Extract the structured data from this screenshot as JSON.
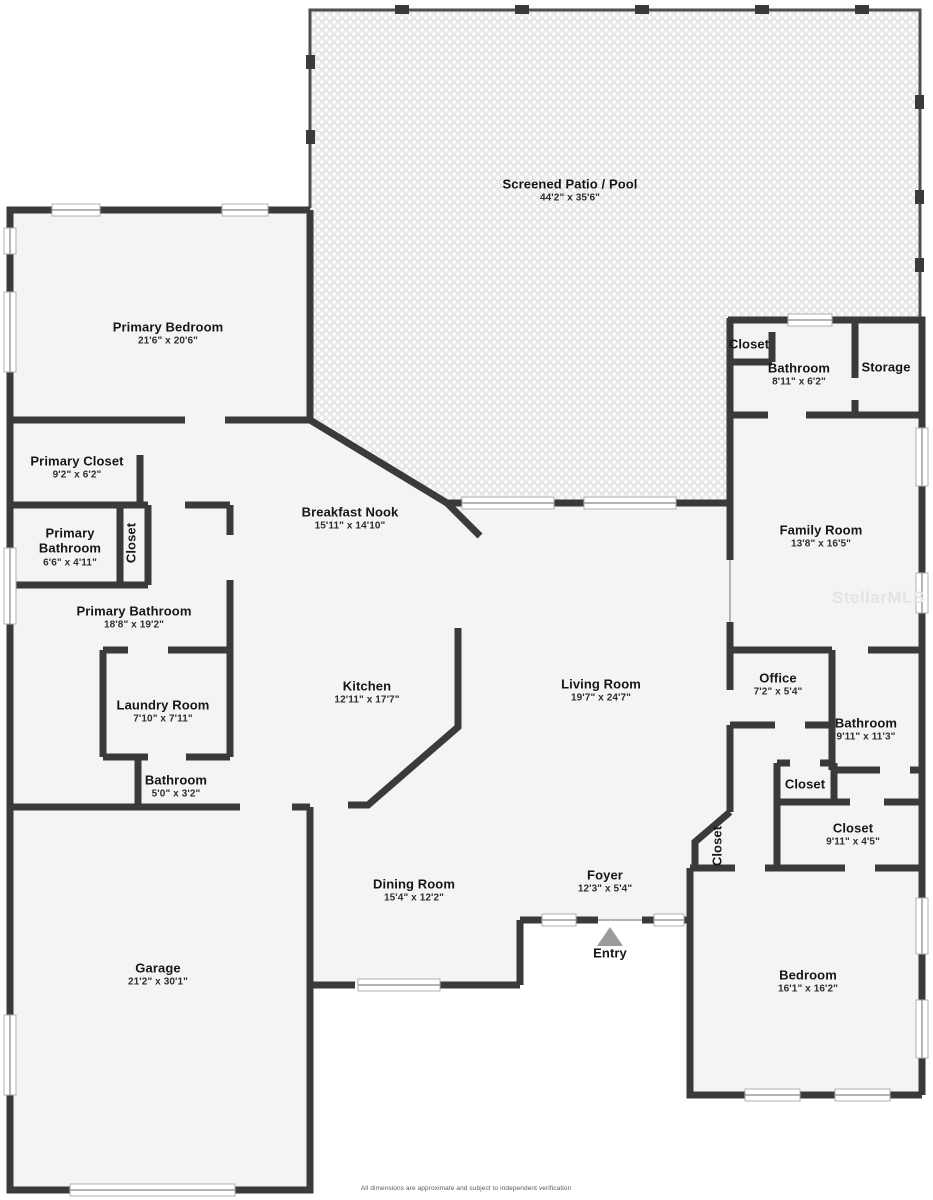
{
  "meta": {
    "watermark": "StellarMLS",
    "disclaimer": "All dimensions are approximate and subject to independent verification"
  },
  "colors": {
    "wall": "#3a3a3c",
    "floor": "#f4f4f4",
    "patio_background": "#ededed",
    "window_frame": "#b0b0b0",
    "entry_arrow": "#9b9b9b",
    "label_text": "#161616"
  },
  "rooms": [
    {
      "id": "screened-patio-pool",
      "name": "Screened Patio / Pool",
      "dims": "44'2\" x 35'6\""
    },
    {
      "id": "primary-bedroom",
      "name": "Primary Bedroom",
      "dims": "21'6\" x 20'6\""
    },
    {
      "id": "primary-closet",
      "name": "Primary Closet",
      "dims": "9'2\" x 6'2\""
    },
    {
      "id": "primary-bathroom-small",
      "name": "Primary Bathroom",
      "dims": "6'6\" x 4'11\""
    },
    {
      "id": "closet-primary",
      "name": "Closet"
    },
    {
      "id": "breakfast-nook",
      "name": "Breakfast Nook",
      "dims": "15'11\" x 14'10\""
    },
    {
      "id": "primary-bathroom",
      "name": "Primary Bathroom",
      "dims": "18'8\" x 19'2\""
    },
    {
      "id": "laundry-room",
      "name": "Laundry Room",
      "dims": "7'10\" x 7'11\""
    },
    {
      "id": "bathroom-small",
      "name": "Bathroom",
      "dims": "5'0\" x 3'2\""
    },
    {
      "id": "kitchen",
      "name": "Kitchen",
      "dims": "12'11\" x 17'7\""
    },
    {
      "id": "living-room",
      "name": "Living Room",
      "dims": "19'7\" x 24'7\""
    },
    {
      "id": "closet-hall",
      "name": "Closet"
    },
    {
      "id": "bathroom-hall",
      "name": "Bathroom",
      "dims": "8'11\" x 6'2\""
    },
    {
      "id": "storage",
      "name": "Storage"
    },
    {
      "id": "family-room",
      "name": "Family Room",
      "dims": "13'8\" x 16'5\""
    },
    {
      "id": "office",
      "name": "Office",
      "dims": "7'2\" x 5'4\""
    },
    {
      "id": "bathroom-right",
      "name": "Bathroom",
      "dims": "9'11\" x 11'3\""
    },
    {
      "id": "closet-small-right",
      "name": "Closet"
    },
    {
      "id": "closet-right",
      "name": "Closet",
      "dims": "9'11\" x 4'5\""
    },
    {
      "id": "closet-foyer",
      "name": "Closet"
    },
    {
      "id": "foyer",
      "name": "Foyer",
      "dims": "12'3\" x 5'4\""
    },
    {
      "id": "dining-room",
      "name": "Dining Room",
      "dims": "15'4\" x 12'2\""
    },
    {
      "id": "garage",
      "name": "Garage",
      "dims": "21'2\" x 30'1\""
    },
    {
      "id": "bedroom",
      "name": "Bedroom",
      "dims": "16'1\" x 16'2\""
    },
    {
      "id": "entry",
      "name": "Entry"
    }
  ]
}
